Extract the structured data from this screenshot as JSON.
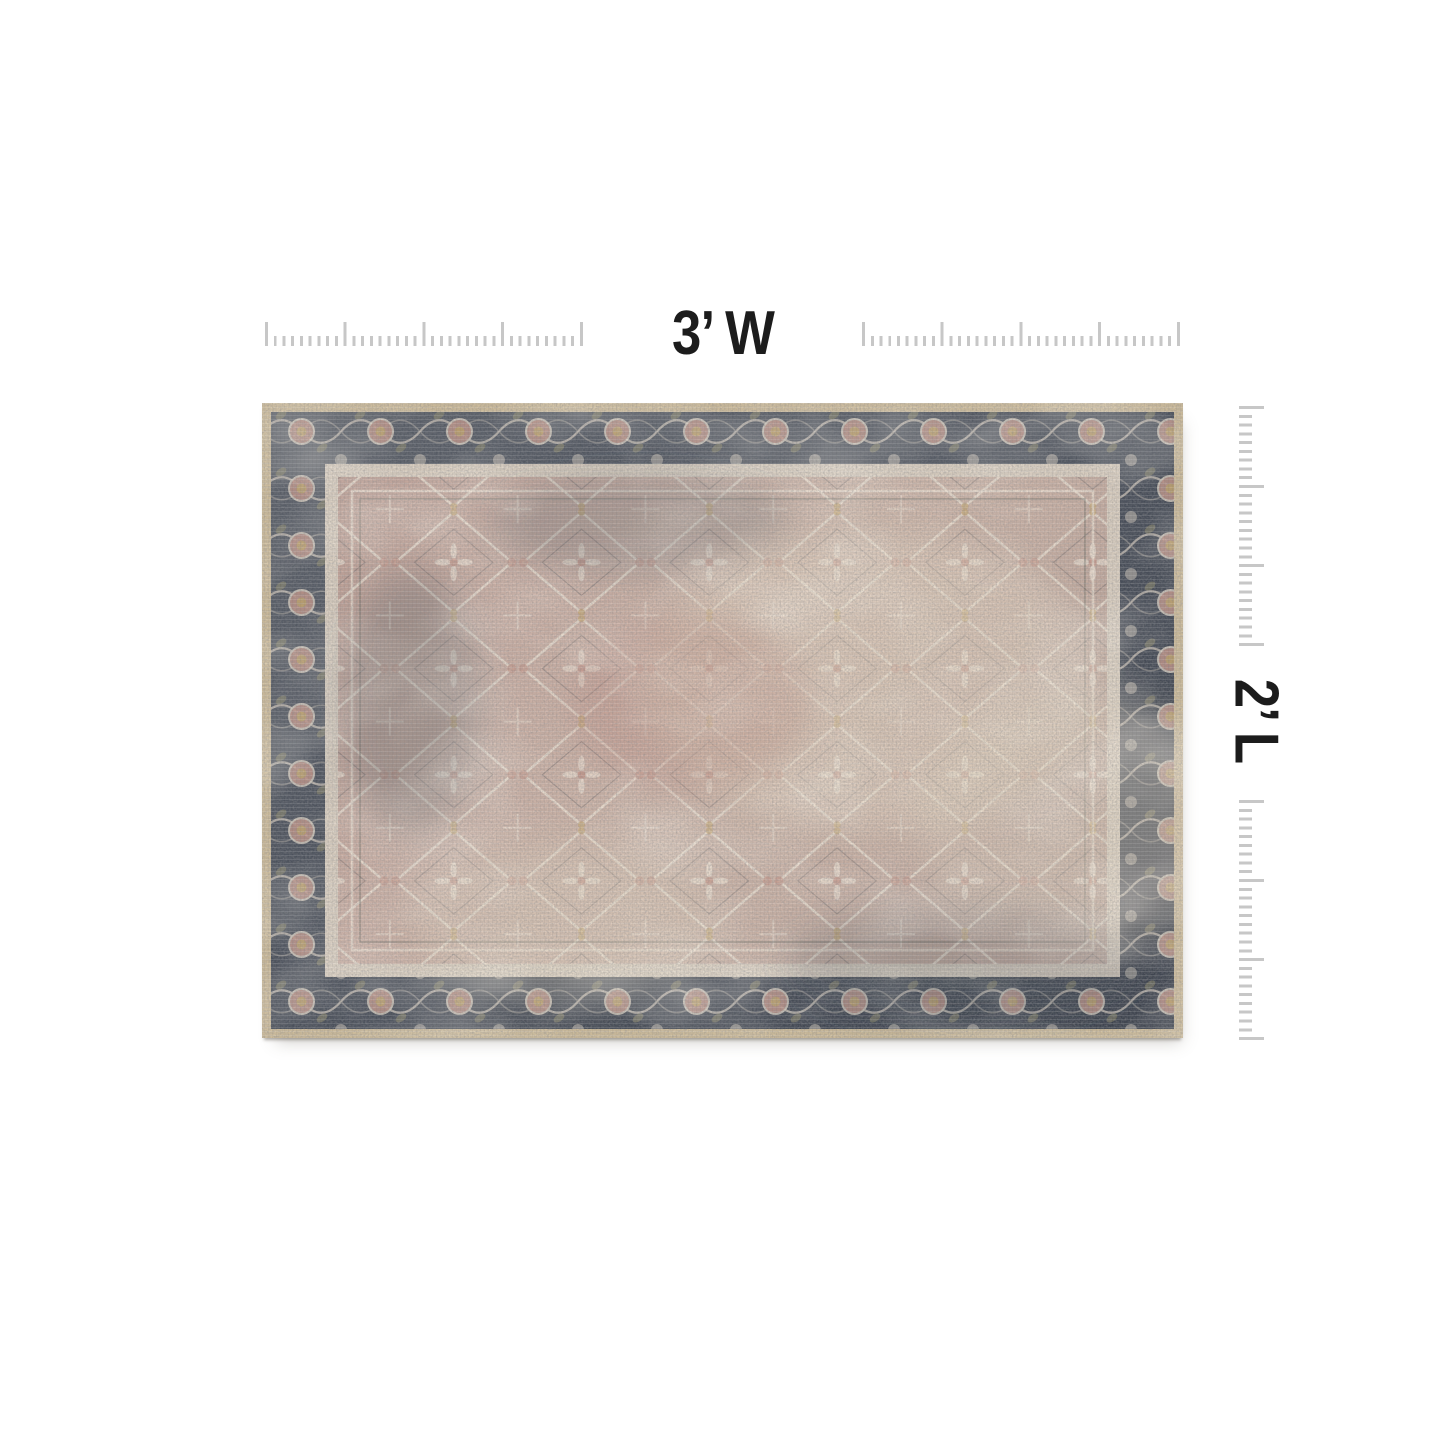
{
  "page": {
    "background_color": "#ffffff"
  },
  "dimension_annotations": {
    "width_label": "3’ W",
    "length_label": "2’ L",
    "label_color": "#1c1c1c",
    "ruler_tick_color": "#c7c7c7"
  },
  "product_image": {
    "description": "distressed vintage Persian-style area rug, blush taupe field with charcoal slate ornamental border and tan serged edge",
    "colors": {
      "binding": "#ccbb9b",
      "border_ground": "#4c525d",
      "border_motif": "#d9cfc1",
      "guard_stripe": "#d8cdbf",
      "field": "#c6aba0",
      "field_motif": "#ece1d3",
      "accent_gold": "#c1a36f",
      "accent_rose": "#c2968a",
      "accent_olive": "#97916f",
      "dark_fleck": "#45444a"
    }
  }
}
